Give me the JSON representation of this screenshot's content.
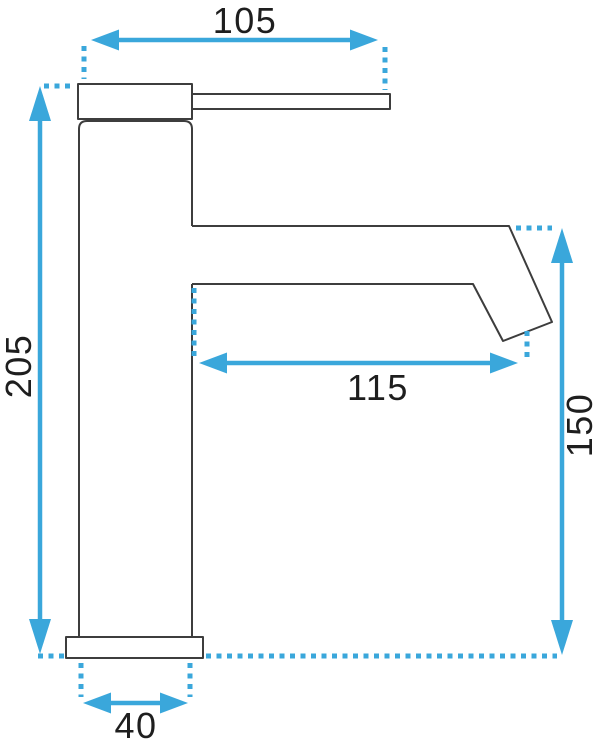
{
  "drawing": {
    "type": "technical-dimension-drawing",
    "subject": "tall single-lever basin faucet, side profile",
    "colors": {
      "dimension_blue": "#3aa7db",
      "outline_dark": "#3d3d3d",
      "label_text": "#1e1e1e",
      "background": "#ffffff"
    },
    "dimensions": {
      "top_width": "105",
      "total_height": "205",
      "spout_reach": "115",
      "spout_height": "150",
      "body_diameter": "40"
    }
  }
}
